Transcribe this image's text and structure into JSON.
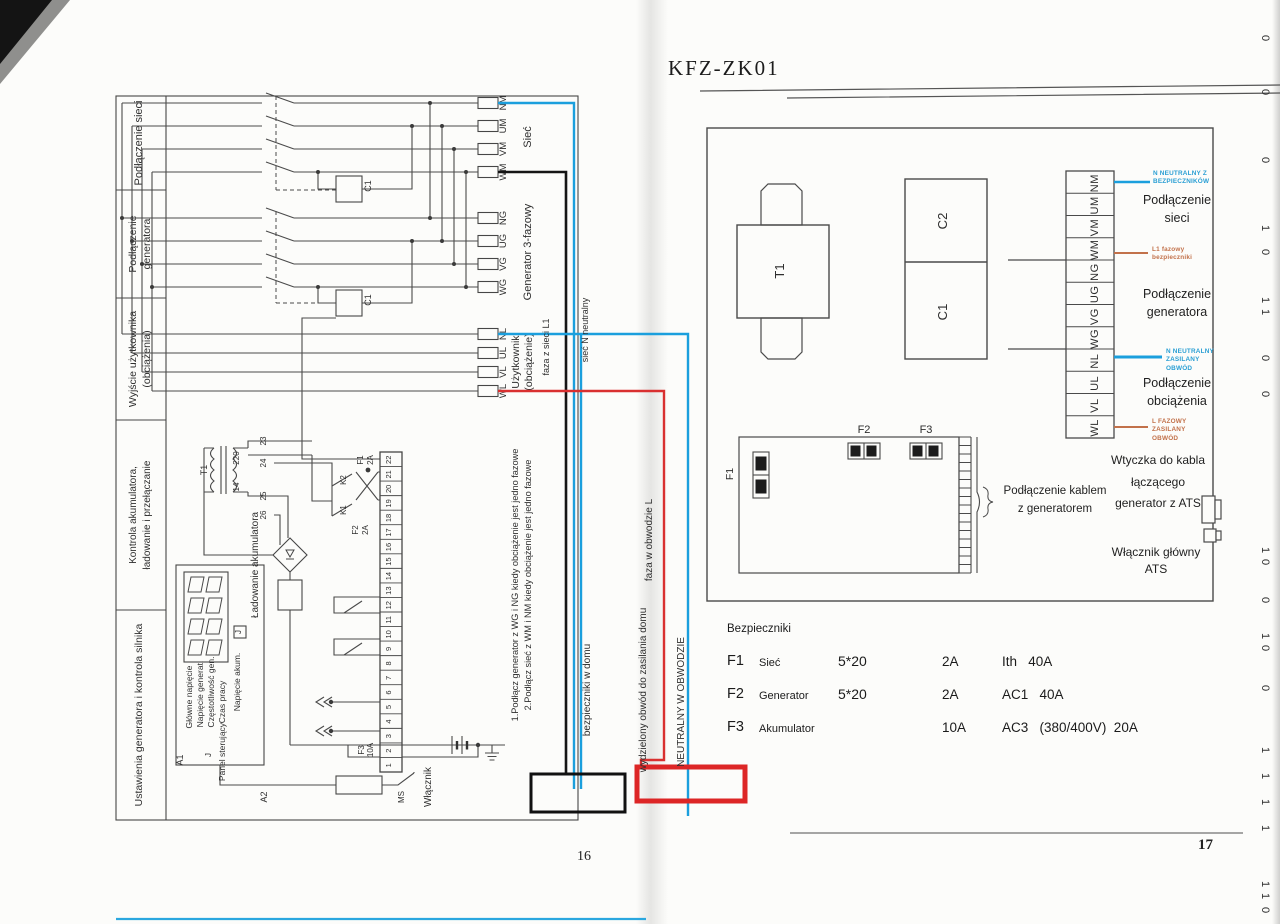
{
  "colors": {
    "line": "#3f3f3f",
    "annotation_blue": "#1b9fdd",
    "annotation_red": "#d93030",
    "annotation_orange": "#c2714a",
    "overlay_black": "#151515",
    "paper": "#fcfcfa"
  },
  "left_page": {
    "page_number": "16",
    "sidebar": [
      [
        "Podłączenie sieci"
      ],
      [
        "Podłączenie",
        "generatora"
      ],
      [
        "Wyjście użytkownika",
        "(obciążenia)"
      ],
      [
        "Kontrola akumulatora,",
        "ładowanie i przełączanie"
      ],
      [
        "Ustawienia generatora i kontrola silnika"
      ]
    ],
    "mains": {
      "labels": [
        "NM",
        "UM",
        "VM",
        "WM"
      ],
      "caption": "Sieć"
    },
    "generator": {
      "labels": [
        "NG",
        "UG",
        "VG",
        "WG"
      ],
      "caption": "Generator 3-fazowy"
    },
    "load": {
      "labels": [
        "NL",
        "UL",
        "VL",
        "WL"
      ],
      "caption_line1": "Użytkownik",
      "caption_line2": "(obciążenie)"
    },
    "contactors": [
      "C1",
      "C1"
    ],
    "strip_numbers": [
      "22",
      "21",
      "20",
      "19",
      "18",
      "17",
      "16",
      "15",
      "14",
      "13",
      "12",
      "11",
      "10",
      "9",
      "8",
      "7",
      "6",
      "5",
      "4",
      "3",
      "2",
      "1"
    ],
    "aux_terminals": [
      "23",
      "24",
      "25",
      "26"
    ],
    "transformer": {
      "label": "T1",
      "primary": "220",
      "secondary": "14"
    },
    "relays": {
      "k2": "K2",
      "k1": "K1",
      "f1": "F1",
      "f1_rating": "2A",
      "f2": "F2",
      "f2_rating": "2A",
      "f3": "F3",
      "f3_rating": "10A"
    },
    "panel": {
      "box": "A1",
      "box2": "A2",
      "jumper": "J",
      "display_labels": [
        "Główne napięcie",
        "Napięcie generat.",
        "Częstotliwość gen.",
        "Czas pracy"
      ],
      "control": "Panel sterujący",
      "battery_v": "Napięcie akum.",
      "charging": "Ładowanie akumulatora",
      "ms": "MS",
      "switch": "Włącznik"
    },
    "notes": [
      "1.Podłącz generator z WG i NG kiedy obciążenie jest jedno fazowe",
      "2.Podłącz sieć z WM i NM kiedy obciążenie jest jedno fazowe"
    ],
    "annotations": {
      "phase_from_mains": "faza z sieci L1",
      "mains_neutral": "sieć  N   neutralny",
      "phase_in_circuit": "faza w  obwodzie L",
      "fuses_at_home": "bezpieczniki w domu",
      "separated_circuit": "wydzielony obwód do zasilania domu",
      "neutral_in_circuit": "NEUTRALNY W OBWODZIE"
    }
  },
  "right_page": {
    "title": "KFZ-ZK01",
    "page_number": "17",
    "components": {
      "t1": "T1",
      "c2": "C2",
      "c1": "C1",
      "f1": "F1",
      "f2": "F2",
      "f3": "F3"
    },
    "terminals": [
      "NM",
      "UM",
      "VM",
      "WM",
      "NG",
      "UG",
      "VG",
      "WG",
      "NL",
      "UL",
      "VL",
      "WL"
    ],
    "groups": [
      "Podłączenie\nsieci",
      "Podłączenie\ngeneratora",
      "Podłączenie\nobciążenia"
    ],
    "annotations": {
      "neutral_fused": "N   NEUTRALNY Z\nBEZPIECZNIKÓW",
      "phase_fused": "L1 fazowy\nbezpieczniki",
      "neutral_load": "N NEUTRALNY\nZASILANY\nOBWÓD",
      "phase_load": "L    FAZOWY\nZASILANY\nOBWÓD"
    },
    "cable_label": "Podłączenie kablem\nz generatorem",
    "plug_label": "Wtyczka do kabla\nłączącego\ngenerator z ATS",
    "main_switch_label": "Włącznik główny ATS",
    "fuses": {
      "heading": "Bezpieczniki",
      "rows": [
        {
          "id": "F1",
          "name": "Sieć",
          "size": "5*20",
          "amp": "2A",
          "spec": "Ith   40A"
        },
        {
          "id": "F2",
          "name": "Generator",
          "size": "5*20",
          "amp": "2A",
          "spec": "AC1   40A"
        },
        {
          "id": "F3",
          "name": "Akumulator",
          "size": "",
          "amp": "10A",
          "spec": "AC3   (380/400V)  20A"
        }
      ]
    }
  },
  "binding_marks": [
    {
      "y": 38,
      "t": "0"
    },
    {
      "y": 92,
      "t": "0"
    },
    {
      "y": 160,
      "t": "0"
    },
    {
      "y": 228,
      "t": "1"
    },
    {
      "y": 252,
      "t": "0"
    },
    {
      "y": 300,
      "t": "1"
    },
    {
      "y": 312,
      "t": "1"
    },
    {
      "y": 358,
      "t": "0"
    },
    {
      "y": 394,
      "t": "0"
    },
    {
      "y": 550,
      "t": "1"
    },
    {
      "y": 562,
      "t": "0"
    },
    {
      "y": 600,
      "t": "0"
    },
    {
      "y": 636,
      "t": "1"
    },
    {
      "y": 648,
      "t": "0"
    },
    {
      "y": 688,
      "t": "0"
    },
    {
      "y": 750,
      "t": "1"
    },
    {
      "y": 776,
      "t": "1"
    },
    {
      "y": 802,
      "t": "1"
    },
    {
      "y": 828,
      "t": "1"
    },
    {
      "y": 884,
      "t": "1"
    },
    {
      "y": 896,
      "t": "1"
    },
    {
      "y": 910,
      "t": "0"
    }
  ]
}
